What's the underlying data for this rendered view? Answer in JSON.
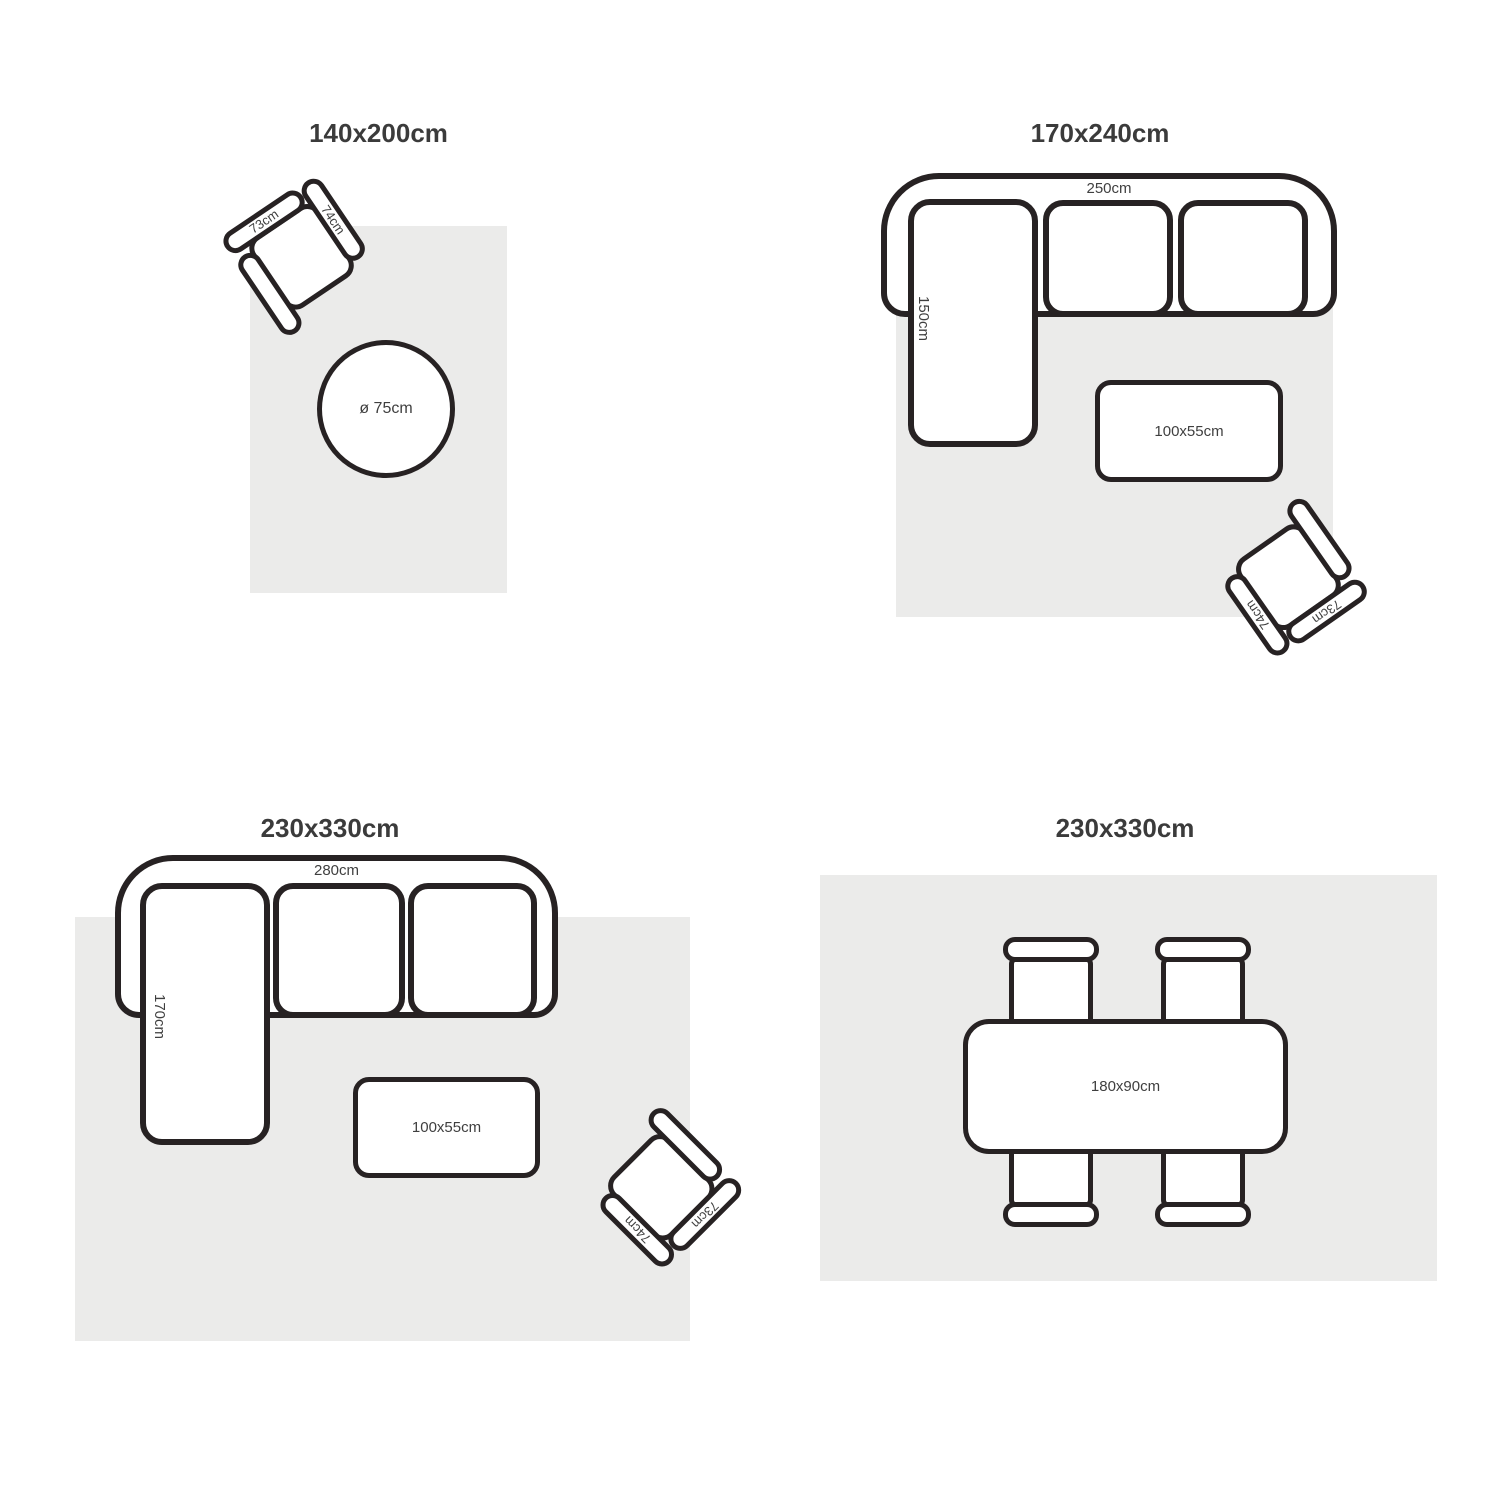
{
  "colors": {
    "outline": "#272223",
    "rug_fill": "#ebebea",
    "title_text": "#3b3b3b",
    "label_text": "#3f3f3f"
  },
  "panels": [
    {
      "id": "rug-140x200",
      "title": "140x200cm",
      "armchair": {
        "back_label": "73cm",
        "arm_label": "74cm"
      },
      "round_table": {
        "label": "ø 75cm"
      }
    },
    {
      "id": "rug-170x240",
      "title": "170x240cm",
      "sofa": {
        "width_label": "250cm",
        "chaise_label": "150cm"
      },
      "coffee_table": {
        "label": "100x55cm"
      },
      "armchair": {
        "back_label": "73cm",
        "arm_label": "74cm"
      }
    },
    {
      "id": "rug-230x330-living",
      "title": "230x330cm",
      "sofa": {
        "width_label": "280cm",
        "chaise_label": "170cm"
      },
      "coffee_table": {
        "label": "100x55cm"
      },
      "armchair": {
        "back_label": "73cm",
        "arm_label": "74cm"
      }
    },
    {
      "id": "rug-230x330-dining",
      "title": "230x330cm",
      "dining_table": {
        "label": "180x90cm"
      }
    }
  ]
}
